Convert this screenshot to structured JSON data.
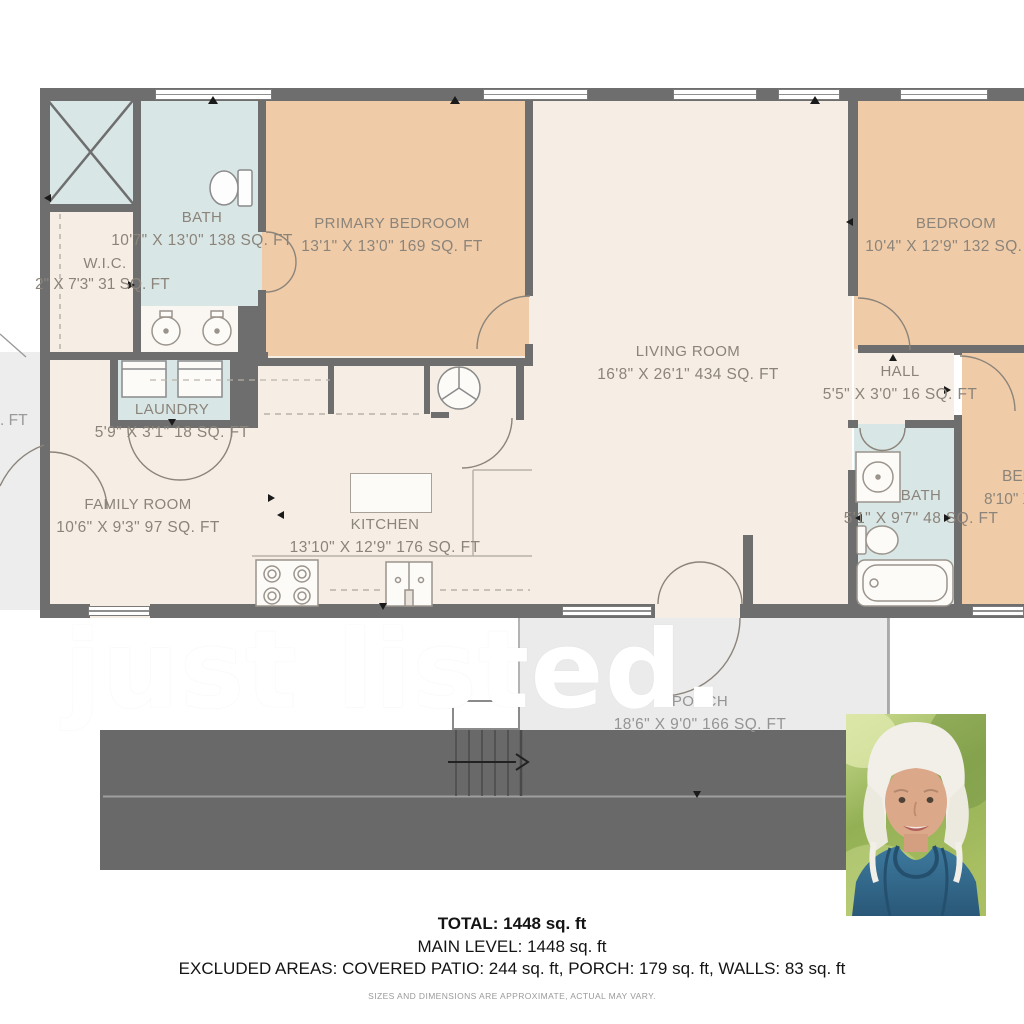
{
  "watermark": "just listed.",
  "rooms": {
    "bath_main": {
      "name": "BATH",
      "dims": "10'7\" X 13'0\" 138 SQ. FT"
    },
    "wic": {
      "name": "W.I.C.",
      "dims": "2\" X 7'3\" 31 SQ. FT"
    },
    "primary_bedroom": {
      "name": "PRIMARY BEDROOM",
      "dims": "13'1\" X 13'0\" 169 SQ. FT"
    },
    "living_room": {
      "name": "LIVING ROOM",
      "dims": "16'8\" X 26'1\" 434 SQ. FT"
    },
    "bedroom_top": {
      "name": "BEDROOM",
      "dims": "10'4\" X 12'9\" 132 SQ. FT"
    },
    "hall": {
      "name": "HALL",
      "dims": "5'5\" X 3'0\" 16 SQ. FT"
    },
    "laundry": {
      "name": "LAUNDRY",
      "dims": "5'9\" X 3'1\" 18 SQ. FT"
    },
    "family_room": {
      "name": "FAMILY ROOM",
      "dims": "10'6\" X 9'3\" 97 SQ. FT"
    },
    "kitchen": {
      "name": "KITCHEN",
      "dims": "13'10\" X 12'9\" 176 SQ. FT"
    },
    "bath_right": {
      "name": "BATH",
      "dims": "5'1\" X 9'7\" 48 SQ. FT"
    },
    "bedroom_right": {
      "name": "BEDROOM",
      "dims": "8'10\" X 1"
    },
    "porch": {
      "name": "PORCH",
      "dims": "18'6\" X 9'0\" 166 SQ. FT"
    },
    "left_partial": {
      "name": "0",
      "dims": ". FT"
    }
  },
  "summary": {
    "total": "TOTAL: 1448 sq. ft",
    "main_level": "MAIN LEVEL: 1448 sq. ft",
    "excluded": "EXCLUDED AREAS: COVERED PATIO: 244 sq. ft, PORCH: 179 sq. ft, WALLS: 83 sq. ft",
    "disclaimer": "SIZES AND DIMENSIONS ARE APPROXIMATE, ACTUAL MAY VARY."
  },
  "colors": {
    "wall": "#6e6e6e",
    "bedroom_fill": "#f0cba8",
    "bathroom_fill": "#d9e6e6",
    "room_fill": "#f6eee4",
    "porch_fill": "#ebebeb",
    "patio_band": "#696969",
    "watermark": "#ffffff",
    "label_text": "#8b847a"
  }
}
